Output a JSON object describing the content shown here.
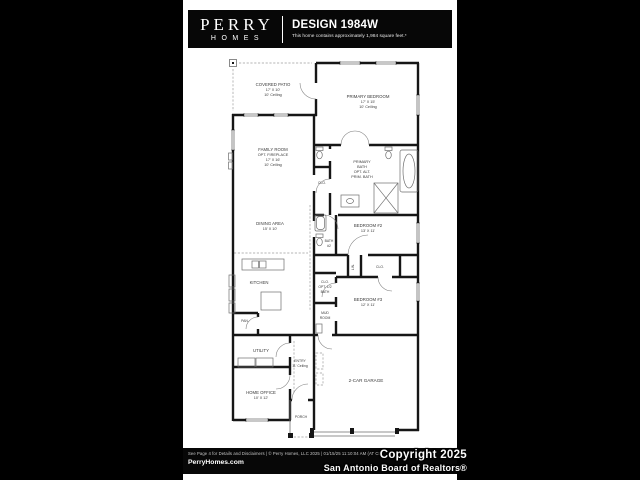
{
  "header": {
    "logo_line1": "PERRY",
    "logo_line2": "HOMES",
    "title": "DESIGN 1984W",
    "subtitle": "This home contains approximately 1,984 square feet.*"
  },
  "plan": {
    "rooms": {
      "covered_patio": {
        "name": "COVERED PATIO",
        "dims": "17' X 10'",
        "ceiling": "10' Ceiling"
      },
      "primary_bedroom": {
        "name": "PRIMARY BEDROOM",
        "dims": "17' X 15'",
        "ceiling": "10' Ceiling"
      },
      "family_room": {
        "name": "FAMILY ROOM",
        "opt": "OPT. FIREPLACE",
        "dims": "17' X 16'",
        "ceiling": "10' Ceiling"
      },
      "primary_bath": {
        "line1": "PRIMARY",
        "line2": "BATH",
        "line3": "OPT. ALT.",
        "line4": "PRIM. BATH"
      },
      "primary_closet": {
        "name": "CLO."
      },
      "dining_area": {
        "name": "DINING AREA",
        "dims": "15' X 10'"
      },
      "kitchen": {
        "name": "KITCHEN"
      },
      "bath_2": {
        "line1": "BATH",
        "line2": "#2"
      },
      "bedroom_2": {
        "name": "BEDROOM #2",
        "dims": "13' X 11'"
      },
      "linen": {
        "name": "LIN."
      },
      "closet_2": {
        "name": "CLO."
      },
      "closet_opt_half_bath": {
        "line1": "CLO.",
        "line2": "OPT. 1/2",
        "line3": "BATH"
      },
      "bedroom_3": {
        "name": "BEDROOM #3",
        "dims": "12' X 11'"
      },
      "mud_room": {
        "line1": "MUD",
        "line2": "ROOM"
      },
      "pantry": {
        "name": "PAN."
      },
      "utility": {
        "name": "UTILITY"
      },
      "entry": {
        "name": "ENTRY",
        "ceiling": "11' Ceiling"
      },
      "home_office": {
        "name": "HOME OFFICE",
        "dims": "10' X 12'"
      },
      "porch": {
        "name": "PORCH"
      },
      "garage": {
        "name": "2-CAR GARAGE"
      }
    }
  },
  "footer": {
    "disclaimer": "See Page 4 for Details and Disclaimers | © Perry Homes, LLC 2025 | 01/15/25 11:10:04 AM (AT CL)",
    "website": "PerryHomes.com"
  },
  "watermark": {
    "line1": "Copyright 2025",
    "line2": "San Antonio Board of Realtors®"
  },
  "colors": {
    "frame_bg": "#000000",
    "page_bg": "#ffffff",
    "wall": "#161616",
    "label": "#3a3a3a"
  }
}
